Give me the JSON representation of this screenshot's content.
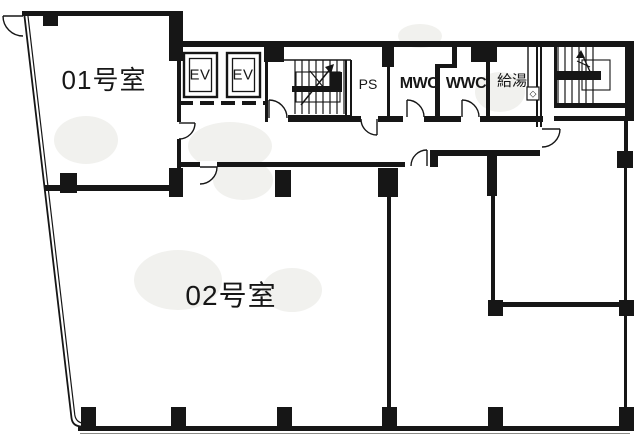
{
  "floorplan": {
    "rooms": {
      "room_01": {
        "label": "01号室"
      },
      "room_02": {
        "label": "02号室"
      },
      "elevator_1": {
        "label": "EV"
      },
      "elevator_2": {
        "label": "EV"
      },
      "pipe_shaft": {
        "label": "PS"
      },
      "male_wc": {
        "label": "MWC"
      },
      "female_wc": {
        "label": "WWC"
      },
      "kitchenette": {
        "label": "給湯"
      }
    },
    "symbols": {
      "kitchenette_valve": "◇"
    },
    "colors": {
      "line": "#161616",
      "background": "#ffffff"
    }
  }
}
